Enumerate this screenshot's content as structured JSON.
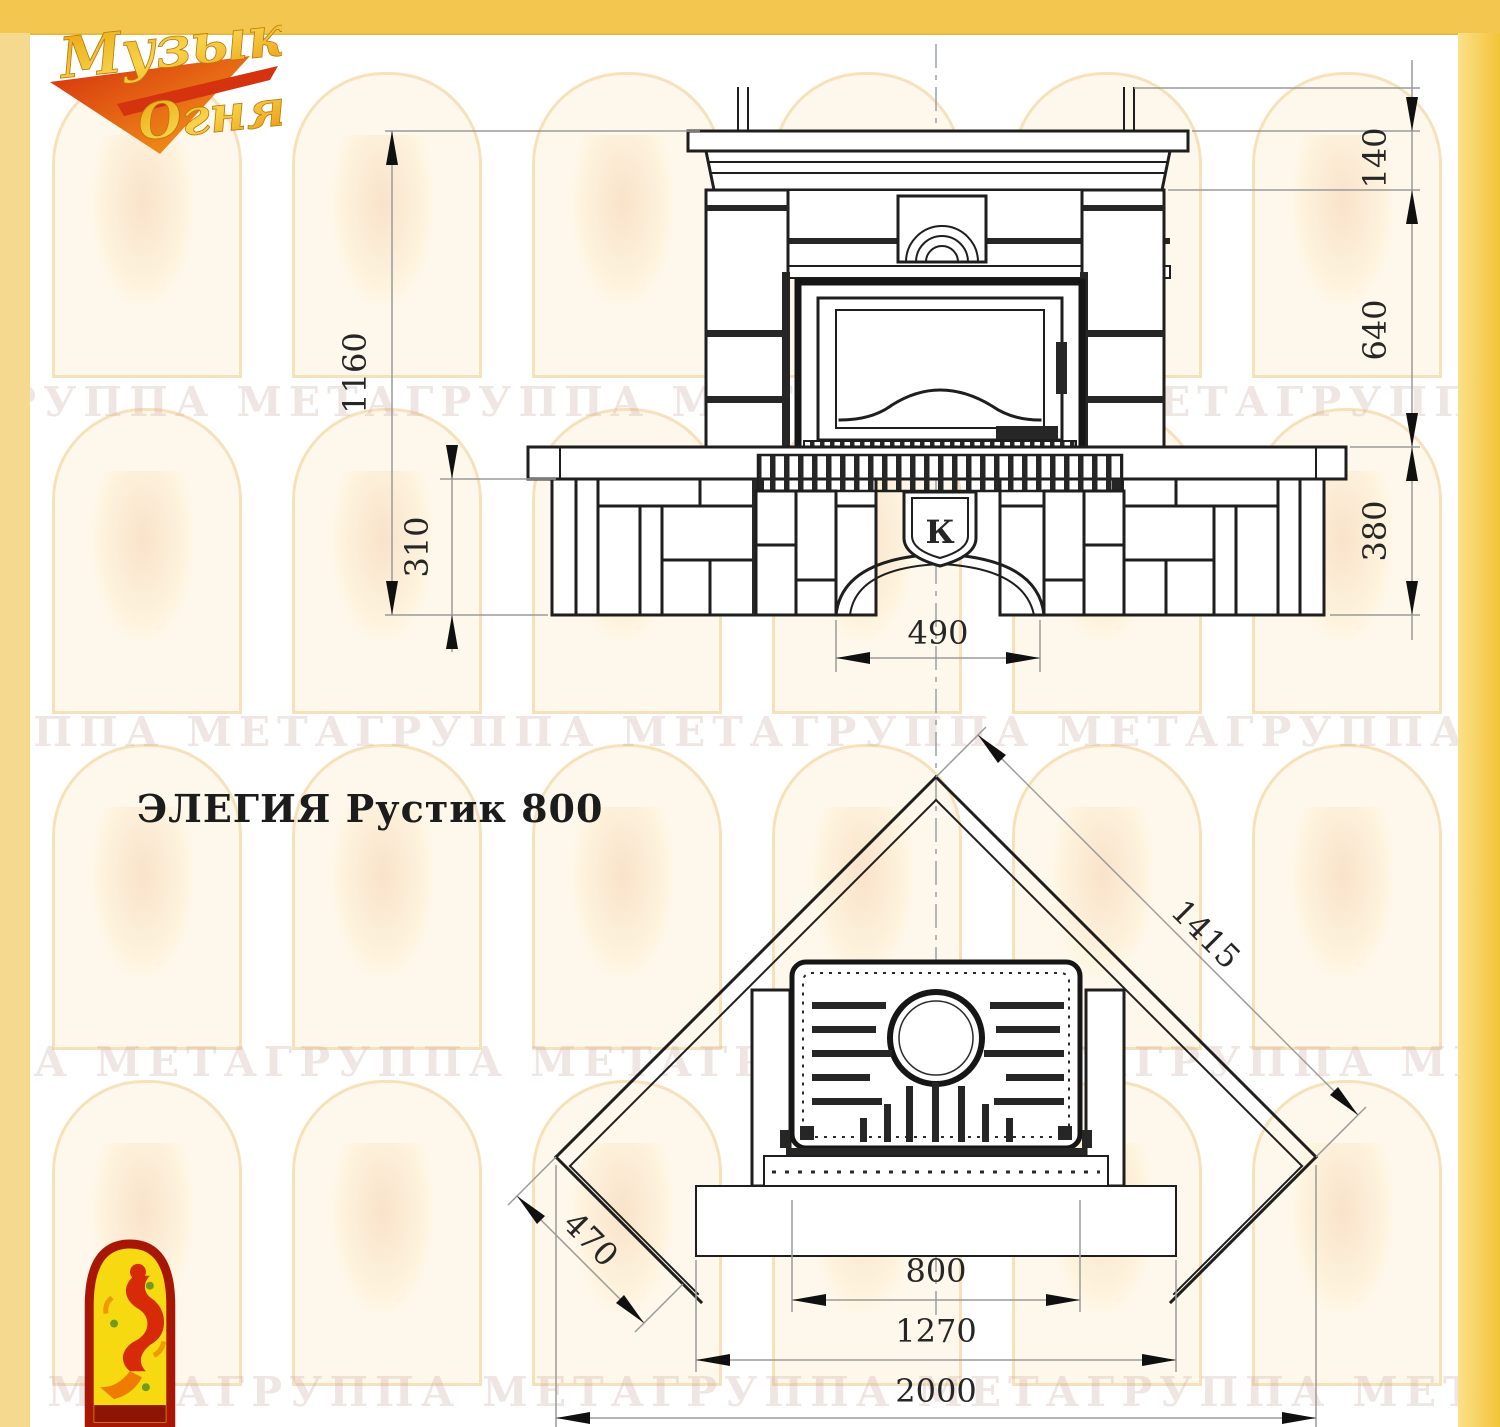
{
  "title": "ЭЛЕГИЯ Рустик 800",
  "logo": {
    "line1": "Музыка",
    "line2": "Огня"
  },
  "watermark": {
    "rows": [
      "ГРУППА МЕТАГРУППА МЕТАГРУППА МЕТАГРУППА МЕТА",
      "ГРУППА МЕТАГРУППА МЕТАГРУППА МЕТАГРУППА МЕТА",
      "ПА МЕТАГРУППА МЕТАГРУППА МЕТАГРУППА МЕТАГРУ",
      "ПА МЕТАГРУППА МЕТАГРУППА МЕТАГРУППА МЕТАГРУ"
    ]
  },
  "front_view": {
    "badge": "К",
    "dims": {
      "total_height": "1160",
      "plinth_height": "310",
      "niche_width": "490",
      "crown_height": "140",
      "middle_height": "640",
      "bench_height": "380"
    }
  },
  "plan_view": {
    "dims": {
      "wall_length": "1415",
      "side_depth": "470",
      "insert_width": "800",
      "hearth_width": "1270",
      "overall_width": "2000"
    }
  },
  "colors": {
    "frame_gold": "#f3c64f",
    "frame_gold_light": "#f5d98f",
    "logo_red": "#d5330f",
    "logo_gold": "#e8a20c",
    "emblem_yellow": "#f7d912",
    "emblem_red": "#a81605",
    "line_dark": "#1e1e1e",
    "dim_gray": "#9a9a9a"
  }
}
